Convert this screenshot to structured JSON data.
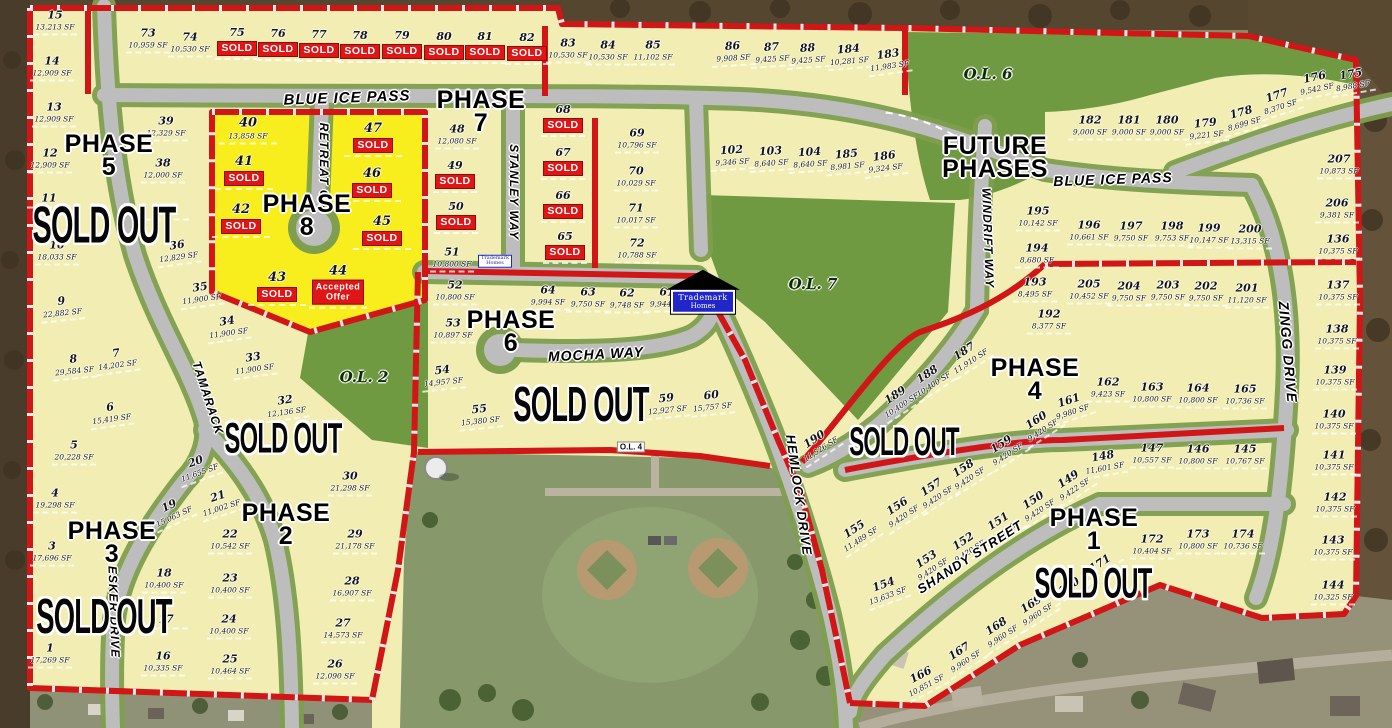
{
  "map_title": "Trademark Homes subdivision plat map",
  "colors": {
    "lot_fill": "#f1edb3",
    "phase8_fill": "#f8ee1e",
    "road_gray": "#bdbdbd",
    "road_green_edge": "#7f9f4e",
    "outlot_green": "#6f9a41",
    "plat_red": "#d01616",
    "sold_red": "#e01515",
    "marker_blue": "#2026c8"
  },
  "badges": {
    "sold": "SOLD",
    "accepted_l1": "Accepted",
    "accepted_l2": "Offer"
  },
  "phases": [
    {
      "l1": "PHASE",
      "l2": "5",
      "x": 109,
      "y": 156
    },
    {
      "l1": "PHASE",
      "l2": "8",
      "x": 307,
      "y": 216
    },
    {
      "l1": "PHASE",
      "l2": "7",
      "x": 481,
      "y": 112
    },
    {
      "l1": "PHASE",
      "l2": "6",
      "x": 511,
      "y": 332
    },
    {
      "l1": "PHASE",
      "l2": "4",
      "x": 1035,
      "y": 380
    },
    {
      "l1": "PHASE",
      "l2": "2",
      "x": 286,
      "y": 525
    },
    {
      "l1": "PHASE",
      "l2": "3",
      "x": 112,
      "y": 543
    },
    {
      "l1": "PHASE",
      "l2": "1",
      "x": 1094,
      "y": 530
    },
    {
      "l1": "FUTURE",
      "l2": "PHASES",
      "x": 995,
      "y": 158
    }
  ],
  "sold_out_labels": [
    {
      "text": "SOLD OUT",
      "x": 104,
      "y": 226,
      "fs": 40
    },
    {
      "text": "SOLD OUT",
      "x": 283,
      "y": 438,
      "fs": 33
    },
    {
      "text": "SOLD OUT",
      "x": 581,
      "y": 406,
      "fs": 38
    },
    {
      "text": "SOLD OUT",
      "x": 904,
      "y": 442,
      "fs": 31
    },
    {
      "text": "SOLD OUT",
      "x": 104,
      "y": 618,
      "fs": 38
    },
    {
      "text": "SOLD OUT",
      "x": 1093,
      "y": 583,
      "fs": 33
    }
  ],
  "streets": [
    {
      "name": "BLUE ICE PASS",
      "x": 347,
      "y": 98,
      "r": -2,
      "fs": 15
    },
    {
      "name": "BLUE ICE PASS",
      "x": 1113,
      "y": 179,
      "r": -2,
      "fs": 14
    },
    {
      "name": "RETREAT CIR",
      "x": 324,
      "y": 168,
      "r": 90,
      "fs": 12
    },
    {
      "name": "STANLEY WAY",
      "x": 514,
      "y": 192,
      "r": 90,
      "fs": 12
    },
    {
      "name": "MOCHA WAY",
      "x": 596,
      "y": 354,
      "r": -3,
      "fs": 14
    },
    {
      "name": "HEMLOCK DRIVE",
      "x": 799,
      "y": 495,
      "r": 82,
      "fs": 13
    },
    {
      "name": "WINDRIFT WAY",
      "x": 988,
      "y": 238,
      "r": 88,
      "fs": 12
    },
    {
      "name": "ZINGG DRIVE",
      "x": 1288,
      "y": 352,
      "r": 85,
      "fs": 14
    },
    {
      "name": "ESKER DRIVE",
      "x": 114,
      "y": 612,
      "r": 88,
      "fs": 12
    },
    {
      "name": "TAMARACK",
      "x": 208,
      "y": 398,
      "r": 72,
      "fs": 12
    },
    {
      "name": "SHANDY STREET",
      "x": 970,
      "y": 557,
      "r": -33,
      "fs": 13
    }
  ],
  "outlots": [
    {
      "name": "O.L. 6",
      "x": 988,
      "y": 74,
      "box": false
    },
    {
      "name": "O.L. 7",
      "x": 813,
      "y": 284,
      "box": false
    },
    {
      "name": "O.L. 2",
      "x": 364,
      "y": 377,
      "box": false
    },
    {
      "name": "O.L. 4",
      "x": 631,
      "y": 447,
      "box": true
    }
  ],
  "markers": {
    "main": {
      "l1": "Trademark",
      "l2": "Homes",
      "x": 703,
      "y": 292
    },
    "small": {
      "l1": "Trademark",
      "l2": "Homes",
      "x": 495,
      "y": 261
    }
  },
  "lots": [
    {
      "n": "15",
      "sf": "13,213 SF",
      "x": 55,
      "y": 22
    },
    {
      "n": "14",
      "sf": "12,909 SF",
      "x": 52,
      "y": 68
    },
    {
      "n": "13",
      "sf": "12,909 SF",
      "x": 54,
      "y": 114
    },
    {
      "n": "12",
      "sf": "12,909 SF",
      "x": 50,
      "y": 160
    },
    {
      "n": "11",
      "sf": "",
      "x": 49,
      "y": 200
    },
    {
      "n": "10",
      "sf": "18,033 SF",
      "x": 57,
      "y": 252
    },
    {
      "n": "9",
      "sf": "22,882 SF",
      "x": 62,
      "y": 308,
      "r": -6
    },
    {
      "n": "8",
      "sf": "29,584 SF",
      "x": 74,
      "y": 366,
      "r": -6
    },
    {
      "n": "7",
      "sf": "14,202 SF",
      "x": 117,
      "y": 360,
      "r": -8
    },
    {
      "n": "6",
      "sf": "15,419 SF",
      "x": 111,
      "y": 414,
      "r": -8
    },
    {
      "n": "5",
      "sf": "20,228 SF",
      "x": 74,
      "y": 452
    },
    {
      "n": "4",
      "sf": "19,298 SF",
      "x": 55,
      "y": 500
    },
    {
      "n": "3",
      "sf": "17,696 SF",
      "x": 52,
      "y": 553
    },
    {
      "n": "1",
      "sf": "17,269 SF",
      "x": 50,
      "y": 655
    },
    {
      "n": "39",
      "sf": "12,329 SF",
      "x": 166,
      "y": 128
    },
    {
      "n": "38",
      "sf": "12,000 SF",
      "x": 163,
      "y": 170
    },
    {
      "n": "37",
      "sf": "",
      "x": 167,
      "y": 212
    },
    {
      "n": "36",
      "sf": "12,829 SF",
      "x": 178,
      "y": 252,
      "r": -8
    },
    {
      "n": "35",
      "sf": "11,900 SF",
      "x": 201,
      "y": 294,
      "r": -8
    },
    {
      "n": "34",
      "sf": "11,900 SF",
      "x": 228,
      "y": 328,
      "r": -8
    },
    {
      "n": "33",
      "sf": "11,900 SF",
      "x": 254,
      "y": 364,
      "r": -8
    },
    {
      "n": "32",
      "sf": "12,136 SF",
      "x": 286,
      "y": 407,
      "r": -8
    },
    {
      "n": "20",
      "sf": "11,655 SF",
      "x": 198,
      "y": 468,
      "r": -20
    },
    {
      "n": "21",
      "sf": "11,002 SF",
      "x": 220,
      "y": 503,
      "r": -18
    },
    {
      "n": "22",
      "sf": "10,542 SF",
      "x": 230,
      "y": 541
    },
    {
      "n": "23",
      "sf": "10,400 SF",
      "x": 230,
      "y": 585
    },
    {
      "n": "24",
      "sf": "10,400 SF",
      "x": 229,
      "y": 626
    },
    {
      "n": "25",
      "sf": "10,464 SF",
      "x": 230,
      "y": 666
    },
    {
      "n": "19",
      "sf": "15,063 SF",
      "x": 172,
      "y": 512,
      "r": -25
    },
    {
      "n": "18",
      "sf": "10,400 SF",
      "x": 164,
      "y": 580
    },
    {
      "n": "17",
      "sf": "",
      "x": 166,
      "y": 621
    },
    {
      "n": "16",
      "sf": "10,335 SF",
      "x": 163,
      "y": 663
    },
    {
      "n": "30",
      "sf": "21,298 SF",
      "x": 350,
      "y": 483
    },
    {
      "n": "29",
      "sf": "21,178 SF",
      "x": 355,
      "y": 541
    },
    {
      "n": "28",
      "sf": "16,907 SF",
      "x": 352,
      "y": 588
    },
    {
      "n": "27",
      "sf": "14,573 SF",
      "x": 343,
      "y": 630
    },
    {
      "n": "26",
      "sf": "12,090 SF",
      "x": 335,
      "y": 671
    },
    {
      "n": "73",
      "sf": "10,959 SF",
      "x": 148,
      "y": 40
    },
    {
      "n": "74",
      "sf": "10,530 SF",
      "x": 190,
      "y": 44
    },
    {
      "n": "75",
      "sf": "",
      "x": 237,
      "y": 43,
      "s": "sold"
    },
    {
      "n": "76",
      "sf": "",
      "x": 278,
      "y": 44,
      "s": "sold"
    },
    {
      "n": "77",
      "sf": "",
      "x": 319,
      "y": 45,
      "s": "sold"
    },
    {
      "n": "78",
      "sf": "",
      "x": 360,
      "y": 46,
      "s": "sold"
    },
    {
      "n": "79",
      "sf": "",
      "x": 402,
      "y": 46,
      "s": "sold"
    },
    {
      "n": "80",
      "sf": "",
      "x": 444,
      "y": 47,
      "s": "sold"
    },
    {
      "n": "81",
      "sf": "",
      "x": 485,
      "y": 47,
      "s": "sold"
    },
    {
      "n": "82",
      "sf": "",
      "x": 527,
      "y": 48,
      "s": "sold"
    },
    {
      "n": "83",
      "sf": "10,530 SF",
      "x": 568,
      "y": 50
    },
    {
      "n": "84",
      "sf": "10,530 SF",
      "x": 608,
      "y": 52
    },
    {
      "n": "85",
      "sf": "11,102 SF",
      "x": 653,
      "y": 52
    },
    {
      "n": "86",
      "sf": "9,908 SF",
      "x": 733,
      "y": 53,
      "r": -4
    },
    {
      "n": "87",
      "sf": "9,425 SF",
      "x": 772,
      "y": 54,
      "r": -4
    },
    {
      "n": "88",
      "sf": "9,425 SF",
      "x": 808,
      "y": 55,
      "r": -4
    },
    {
      "n": "184",
      "sf": "10,281 SF",
      "x": 849,
      "y": 56,
      "r": -5
    },
    {
      "n": "183",
      "sf": "11,983 SF",
      "x": 889,
      "y": 61,
      "r": -8
    },
    {
      "n": "40",
      "sf": "13,858 SF",
      "x": 248,
      "y": 130,
      "p8": true
    },
    {
      "n": "41",
      "sf": "",
      "x": 244,
      "y": 172,
      "s": "sold",
      "p8": true
    },
    {
      "n": "42",
      "sf": "",
      "x": 241,
      "y": 220,
      "s": "sold",
      "p8": true
    },
    {
      "n": "43",
      "sf": "",
      "x": 277,
      "y": 288,
      "s": "sold",
      "p8": true
    },
    {
      "n": "44",
      "sf": "",
      "x": 338,
      "y": 286,
      "s": "accepted",
      "p8": true
    },
    {
      "n": "45",
      "sf": "",
      "x": 382,
      "y": 232,
      "s": "sold",
      "p8": true
    },
    {
      "n": "46",
      "sf": "",
      "x": 372,
      "y": 184,
      "s": "sold",
      "p8": true
    },
    {
      "n": "47",
      "sf": "",
      "x": 373,
      "y": 139,
      "s": "sold",
      "p8": true
    },
    {
      "n": "48",
      "sf": "12,080 SF",
      "x": 457,
      "y": 136
    },
    {
      "n": "49",
      "sf": "",
      "x": 455,
      "y": 176,
      "s": "sold"
    },
    {
      "n": "50",
      "sf": "",
      "x": 456,
      "y": 217,
      "s": "sold"
    },
    {
      "n": "51",
      "sf": "10,800 SF",
      "x": 452,
      "y": 259
    },
    {
      "n": "68",
      "sf": "",
      "x": 563,
      "y": 120,
      "s": "sold"
    },
    {
      "n": "67",
      "sf": "",
      "x": 563,
      "y": 163,
      "s": "sold"
    },
    {
      "n": "66",
      "sf": "",
      "x": 563,
      "y": 206,
      "s": "sold"
    },
    {
      "n": "65",
      "sf": "",
      "x": 565,
      "y": 247,
      "s": "sold"
    },
    {
      "n": "69",
      "sf": "10,796 SF",
      "x": 637,
      "y": 140
    },
    {
      "n": "70",
      "sf": "10,029 SF",
      "x": 636,
      "y": 178
    },
    {
      "n": "71",
      "sf": "10,017 SF",
      "x": 636,
      "y": 215
    },
    {
      "n": "72",
      "sf": "10,788 SF",
      "x": 637,
      "y": 250
    },
    {
      "n": "52",
      "sf": "10,800 SF",
      "x": 455,
      "y": 292
    },
    {
      "n": "53",
      "sf": "10,897 SF",
      "x": 453,
      "y": 330
    },
    {
      "n": "54",
      "sf": "14,957 SF",
      "x": 443,
      "y": 377,
      "r": -6
    },
    {
      "n": "55",
      "sf": "15,380 SF",
      "x": 480,
      "y": 416,
      "r": -6
    },
    {
      "n": "64",
      "sf": "9,994 SF",
      "x": 548,
      "y": 297
    },
    {
      "n": "63",
      "sf": "9,750 SF",
      "x": 588,
      "y": 299
    },
    {
      "n": "62",
      "sf": "9,748 SF",
      "x": 627,
      "y": 300
    },
    {
      "n": "61",
      "sf": "9,944 SF",
      "x": 667,
      "y": 299
    },
    {
      "n": "59",
      "sf": "12,927 SF",
      "x": 667,
      "y": 405,
      "r": -6
    },
    {
      "n": "60",
      "sf": "15,757 SF",
      "x": 712,
      "y": 402,
      "r": -6
    },
    {
      "n": "102",
      "sf": "9,346 SF",
      "x": 732,
      "y": 157,
      "r": -4
    },
    {
      "n": "103",
      "sf": "8,640 SF",
      "x": 771,
      "y": 158,
      "r": -4
    },
    {
      "n": "104",
      "sf": "8,640 SF",
      "x": 810,
      "y": 159,
      "r": -4
    },
    {
      "n": "185",
      "sf": "8,981 SF",
      "x": 847,
      "y": 161,
      "r": -5
    },
    {
      "n": "186",
      "sf": "9,324 SF",
      "x": 885,
      "y": 163,
      "r": -7
    },
    {
      "n": "182",
      "sf": "9,000 SF",
      "x": 1090,
      "y": 127
    },
    {
      "n": "181",
      "sf": "9,000 SF",
      "x": 1129,
      "y": 127
    },
    {
      "n": "180",
      "sf": "9,000 SF",
      "x": 1167,
      "y": 127
    },
    {
      "n": "179",
      "sf": "9,221 SF",
      "x": 1206,
      "y": 130,
      "r": -6
    },
    {
      "n": "178",
      "sf": "8,699 SF",
      "x": 1243,
      "y": 119,
      "r": -16
    },
    {
      "n": "177",
      "sf": "8,370 SF",
      "x": 1279,
      "y": 102,
      "r": -18
    },
    {
      "n": "176",
      "sf": "9,542 SF",
      "x": 1316,
      "y": 84,
      "r": -12
    },
    {
      "n": "175",
      "sf": "8,988 SF",
      "x": 1352,
      "y": 81,
      "r": -10
    },
    {
      "n": "207",
      "sf": "10,873 SF",
      "x": 1339,
      "y": 166
    },
    {
      "n": "206",
      "sf": "9,381 SF",
      "x": 1337,
      "y": 210
    },
    {
      "n": "195",
      "sf": "10,142 SF",
      "x": 1038,
      "y": 218
    },
    {
      "n": "196",
      "sf": "10,661 SF",
      "x": 1089,
      "y": 232
    },
    {
      "n": "197",
      "sf": "9,750 SF",
      "x": 1131,
      "y": 233
    },
    {
      "n": "198",
      "sf": "9,753 SF",
      "x": 1172,
      "y": 233
    },
    {
      "n": "199",
      "sf": "10,147 SF",
      "x": 1209,
      "y": 235
    },
    {
      "n": "200",
      "sf": "13,315 SF",
      "x": 1250,
      "y": 236
    },
    {
      "n": "194",
      "sf": "8,680 SF",
      "x": 1037,
      "y": 255
    },
    {
      "n": "193",
      "sf": "8,495 SF",
      "x": 1035,
      "y": 289
    },
    {
      "n": "192",
      "sf": "8,377 SF",
      "x": 1049,
      "y": 321
    },
    {
      "n": "205",
      "sf": "10,452 SF",
      "x": 1089,
      "y": 291
    },
    {
      "n": "204",
      "sf": "9,750 SF",
      "x": 1129,
      "y": 293
    },
    {
      "n": "203",
      "sf": "9,750 SF",
      "x": 1168,
      "y": 292
    },
    {
      "n": "202",
      "sf": "9,750 SF",
      "x": 1206,
      "y": 293
    },
    {
      "n": "201",
      "sf": "11,120 SF",
      "x": 1247,
      "y": 295
    },
    {
      "n": "136",
      "sf": "10,375 SF",
      "x": 1338,
      "y": 246
    },
    {
      "n": "137",
      "sf": "10,375 SF",
      "x": 1338,
      "y": 292
    },
    {
      "n": "138",
      "sf": "10,375 SF",
      "x": 1337,
      "y": 336
    },
    {
      "n": "139",
      "sf": "10,375 SF",
      "x": 1335,
      "y": 377
    },
    {
      "n": "140",
      "sf": "10,375 SF",
      "x": 1334,
      "y": 421
    },
    {
      "n": "141",
      "sf": "10,375 SF",
      "x": 1334,
      "y": 462
    },
    {
      "n": "142",
      "sf": "10,375 SF",
      "x": 1335,
      "y": 504
    },
    {
      "n": "143",
      "sf": "10,375 SF",
      "x": 1333,
      "y": 547
    },
    {
      "n": "144",
      "sf": "10,325 SF",
      "x": 1333,
      "y": 592
    },
    {
      "n": "187",
      "sf": "11,910 SF",
      "x": 968,
      "y": 357,
      "r": -33
    },
    {
      "n": "188",
      "sf": "10,400 SF",
      "x": 931,
      "y": 380,
      "r": -33
    },
    {
      "n": "189",
      "sf": "10,400 SF",
      "x": 899,
      "y": 401,
      "r": -33
    },
    {
      "n": "190",
      "sf": "11,526 SF",
      "x": 818,
      "y": 445,
      "r": -33
    },
    {
      "n": "161",
      "sf": "9,980 SF",
      "x": 1071,
      "y": 407,
      "r": -18
    },
    {
      "n": "162",
      "sf": "9,423 SF",
      "x": 1108,
      "y": 389
    },
    {
      "n": "163",
      "sf": "10,800 SF",
      "x": 1152,
      "y": 394
    },
    {
      "n": "164",
      "sf": "10,800 SF",
      "x": 1198,
      "y": 395
    },
    {
      "n": "165",
      "sf": "10,736 SF",
      "x": 1245,
      "y": 396
    },
    {
      "n": "160",
      "sf": "9,420 SF",
      "x": 1040,
      "y": 426,
      "r": -33
    },
    {
      "n": "159",
      "sf": "9,420 SF",
      "x": 1005,
      "y": 450,
      "r": -33
    },
    {
      "n": "158",
      "sf": "9,420 SF",
      "x": 967,
      "y": 474,
      "r": -33
    },
    {
      "n": "157",
      "sf": "9,420 SF",
      "x": 935,
      "y": 493,
      "r": -33
    },
    {
      "n": "148",
      "sf": "11,601 SF",
      "x": 1104,
      "y": 463,
      "r": -10
    },
    {
      "n": "147",
      "sf": "10,557 SF",
      "x": 1152,
      "y": 455
    },
    {
      "n": "146",
      "sf": "10,800 SF",
      "x": 1198,
      "y": 456
    },
    {
      "n": "145",
      "sf": "10,767 SF",
      "x": 1245,
      "y": 456
    },
    {
      "n": "149",
      "sf": "9,422 SF",
      "x": 1072,
      "y": 485,
      "r": -33
    },
    {
      "n": "150",
      "sf": "9,420 SF",
      "x": 1037,
      "y": 506,
      "r": -33
    },
    {
      "n": "151",
      "sf": "9,420 SF",
      "x": 1002,
      "y": 527,
      "r": -33
    },
    {
      "n": "152",
      "sf": "9,420 SF",
      "x": 967,
      "y": 547,
      "r": -33
    },
    {
      "n": "153",
      "sf": "9,420 SF",
      "x": 930,
      "y": 565,
      "r": -33
    },
    {
      "n": "154",
      "sf": "13,633 SF",
      "x": 886,
      "y": 591,
      "r": -20
    },
    {
      "n": "155",
      "sf": "11,489 SF",
      "x": 858,
      "y": 535,
      "r": -33
    },
    {
      "n": "156",
      "sf": "9,420 SF",
      "x": 901,
      "y": 512,
      "r": -33
    },
    {
      "n": "166",
      "sf": "10,851 SF",
      "x": 924,
      "y": 681,
      "r": -28
    },
    {
      "n": "167",
      "sf": "9,960 SF",
      "x": 963,
      "y": 657,
      "r": -33
    },
    {
      "n": "168",
      "sf": "9,960 SF",
      "x": 1000,
      "y": 632,
      "r": -33
    },
    {
      "n": "169",
      "sf": "9,960 SF",
      "x": 1035,
      "y": 610,
      "r": -33
    },
    {
      "n": "170",
      "sf": "",
      "x": 1070,
      "y": 588,
      "r": -33
    },
    {
      "n": "171",
      "sf": "",
      "x": 1101,
      "y": 565,
      "r": -33
    },
    {
      "n": "172",
      "sf": "10,404 SF",
      "x": 1152,
      "y": 546
    },
    {
      "n": "173",
      "sf": "10,800 SF",
      "x": 1198,
      "y": 541
    },
    {
      "n": "174",
      "sf": "10,736 SF",
      "x": 1243,
      "y": 541
    }
  ]
}
